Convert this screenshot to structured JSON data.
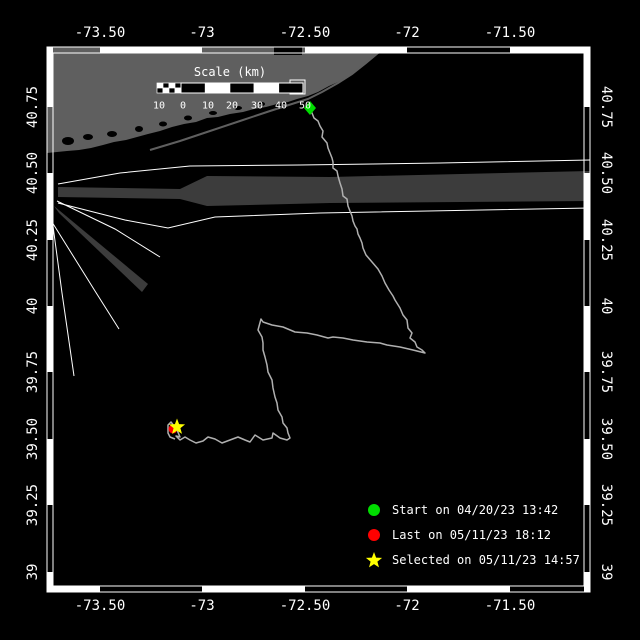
{
  "colors": {
    "background": "#000000",
    "frame": "#ffffff",
    "land": "#5f5f5f",
    "shipping_lane": "#3c3c3c",
    "track": "#b0b0b0",
    "label_text": "#ffffff",
    "start_marker": "#00dd00",
    "last_marker": "#ff0000",
    "selected_marker": "#ffff00"
  },
  "axes": {
    "top": [
      "-73.50",
      "-73",
      "-72.50",
      "-72",
      "-71.50"
    ],
    "bottom": [
      "-73.50",
      "-73",
      "-72.50",
      "-72",
      "-71.50"
    ],
    "left": [
      "40.75",
      "40.50",
      "40.25",
      "40",
      "39.75",
      "39.50",
      "39.25",
      "39"
    ],
    "right": [
      "40.75",
      "40.50",
      "40.25",
      "40",
      "39.75",
      "39.50",
      "39.25",
      "39"
    ]
  },
  "scale_bar": {
    "title": "Scale (km)",
    "labels": [
      "10",
      "0",
      "10",
      "20",
      "30",
      "40",
      "50"
    ]
  },
  "legend": {
    "items": [
      {
        "marker": "start-circle",
        "shape": "circle",
        "color": "#00dd00",
        "label": "Start on 04/20/23 13:42"
      },
      {
        "marker": "last-circle",
        "shape": "circle",
        "color": "#ff0000",
        "label": "Last on 05/11/23 18:12"
      },
      {
        "marker": "selected-star",
        "shape": "star",
        "color": "#ffff00",
        "label": "Selected on 05/11/23 14:57"
      }
    ]
  },
  "geometry": {
    "frame": {
      "x1": 47,
      "y1": 47,
      "x2": 590,
      "y2": 592,
      "inset": 6
    },
    "lon_tick_x": [
      100,
      202,
      305,
      407,
      510
    ],
    "lat_tick_y": [
      107,
      173,
      240,
      306,
      372,
      439,
      505,
      572
    ],
    "zebra_phase": {
      "top": "B",
      "bottom": "W",
      "left": "W",
      "right": "W"
    },
    "land_path": "M47,47 L390,47 L383,50 L374,57 L366,62 L358,69 L348,76 L338,82 L329,86 L318,92 L308,96 L297,99 L288,102 L277,104 L266,107 L254,109 L243,112 L230,114 L218,117 L207,118 L196,122 L184,124 L172,127 L160,131 L148,134 L137,137 L126,140 L114,142 L103,145 L91,148 L79,150 L67,151 L57,152 L47,153 Z",
    "beach_path": "M150,150 L180,141 L210,131 L240,121 L270,111 L295,103 L308,99 L322,92 L338,83 L352,74 L366,63 L378,53 L386,48",
    "bay_ellipses": [
      [
        68,
        141,
        6,
        4
      ],
      [
        88,
        137,
        5,
        3
      ],
      [
        112,
        134,
        5,
        3
      ],
      [
        139,
        129,
        4,
        3
      ],
      [
        163,
        124,
        4,
        2.5
      ],
      [
        188,
        118,
        4,
        2.5
      ],
      [
        213,
        113,
        4,
        2
      ],
      [
        238,
        108,
        4,
        2
      ],
      [
        262,
        104,
        3,
        2
      ]
    ],
    "harbor_notch": [
      274,
      47,
      28,
      8
    ],
    "station_box": [
      290,
      80,
      15,
      14
    ],
    "lane_band_main": "M58,187 L180,189 L207,176 L330,177 L590,171 L590,201 L330,203 L207,206 L180,199 L58,197 Z",
    "lane_band_diag": "M54,206 L59,213 L142,292 L148,284 Z",
    "lane_lines": [
      "M58,184 L120,173 L190,166 L300,165 L440,163 L590,160",
      "M58,203 L125,220 L168,228 L215,217 L320,213 L590,208",
      "M57,201 L115,229 L160,257",
      "M52,222 L95,291 L119,329",
      "M51,211 L62,293 L74,376"
    ],
    "track_path": "M310,108 L312,113 L314,118 L318,121 L320,126 L323,131 L322,137 L327,143 L328,148 L330,153 L332,158 L333,162 L333,168 L337,171 L338,176 L340,183 L342,189 L343,196 L347,199 L348,206 L350,211 L352,216 L353,221 L355,226 L357,229 L358,234 L360,238 L362,243 L363,248 L366,255 L372,262 L378,269 L382,276 L385,283 L389,290 L393,296 L395,300 L400,308 L403,315 L407,320 L408,328 L412,333 L410,338 L415,342 L417,347 L422,350 L425,353 L413,350 L400,347 L387,345 L380,343 L367,342 L353,340 L343,338 L333,337 L328,338 L317,335 L307,333 L295,332 L283,327 L272,325 L263,322 L261,319 L258,330 L262,337 L263,343 L263,350 L265,357 L267,365 L268,372 L272,380 L273,388 L275,397 L277,403 L278,410 L282,417 L283,423 L287,428 L288,433 L290,438 L287,440 L280,438 L273,433 L272,438 L263,440 L255,435 L250,442 L245,440 L238,437 L230,440 L222,443 L215,439 L208,437 L203,441 L196,443 L190,440 L185,437 L180,440 L176,436 L180,437 L177,430 L171,422 L168,425 L168,433 L170,437 L175,439",
    "start_marker": {
      "cx": 310,
      "cy": 108,
      "r": 7
    },
    "last_marker": {
      "cx": 173,
      "cy": 429,
      "r": 4.5
    },
    "selected_marker": {
      "cx": 177,
      "cy": 427,
      "R": 8.5,
      "r": 3.6
    },
    "scale_bar": {
      "x": 157,
      "y": 83,
      "w": 146,
      "h": 10,
      "checks_end": 181,
      "title_cx": 230,
      "title_cy": 72,
      "num_y": 106,
      "num_x": [
        159,
        183,
        208,
        232,
        257,
        281,
        305
      ]
    },
    "axis_label_pos": {
      "top_y": 33,
      "bottom_y": 606,
      "left_x": 33,
      "right_x": 606
    },
    "legend_layout": {
      "marker_x": 374,
      "text_x": 392,
      "row_y": [
        510,
        535,
        560
      ]
    }
  }
}
